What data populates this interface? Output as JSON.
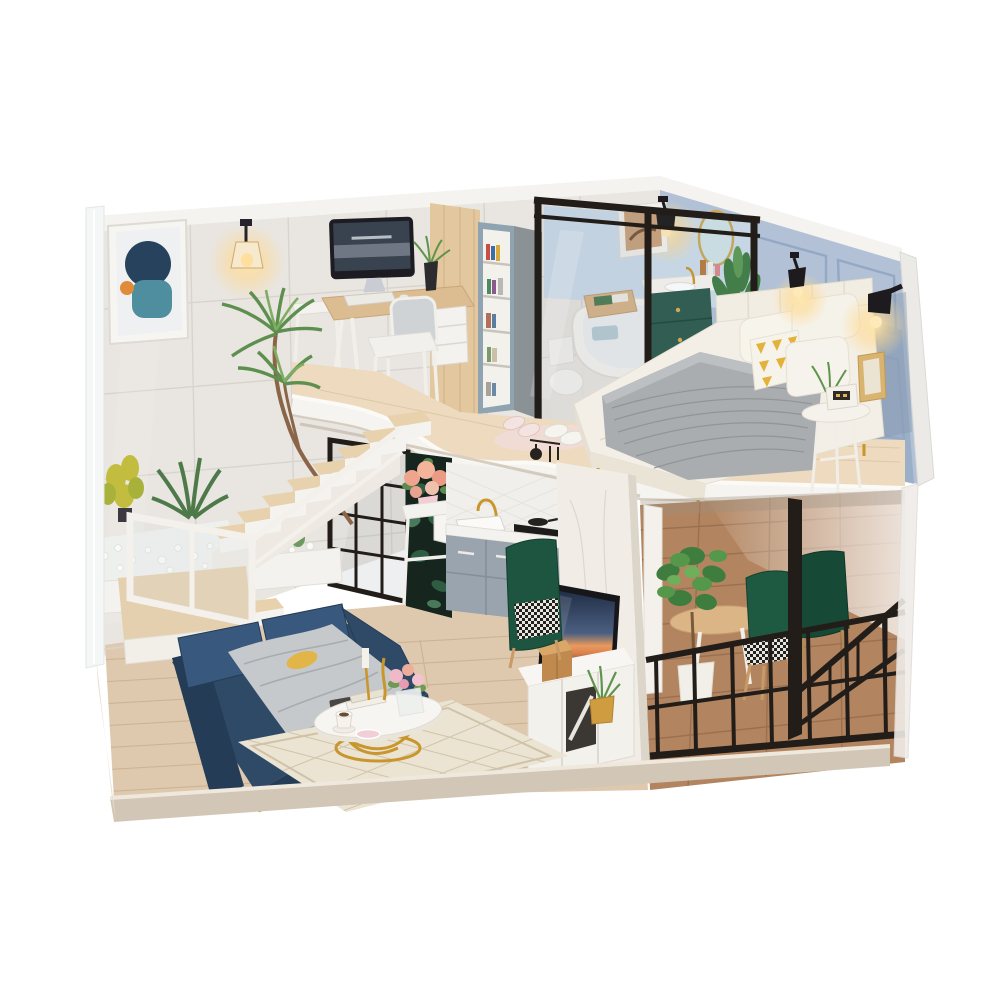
{
  "scene": {
    "type": "product-photo",
    "subject": "DIY miniature dollhouse kit — modern two-story loft apartment diorama with furniture, warm LED lights and acrylic dust cover, photographed on a plain white background",
    "view": "three-quarter view from front-right, roof open",
    "background": "#ffffff"
  },
  "colors": {
    "bg": "#ffffff",
    "wall_marble": "#e9e5e0",
    "wall_grout": "#d6d1ca",
    "wall_blue": "#b2c1d6",
    "wall_blue_dark": "#93a8c4",
    "wall_rim": "#f4f3f0",
    "wood_partition": "#e3c79f",
    "loft_fascia": "#f6f4f0",
    "loft_floor": "#eddabf",
    "floor_living": "#dfc9ae",
    "floor_plank": "#c3a988",
    "deck_wood": "#b28560",
    "deck_plank": "#936a4b",
    "base_fascia": "#d2c6b6",
    "stair_tread": "#e8d2ad",
    "stair_white": "#f3f0ea",
    "sofa_navy": "#2e4a66",
    "sofa_navy_dark": "#243c55",
    "sofa_cushion": "#38587d",
    "throw_gray": "#c6c9cb",
    "accent_yellow": "#e4b23a",
    "gold": "#c9962e",
    "black_metal": "#221d19",
    "vanity_green": "#2c5a4e",
    "chair_green": "#1e5a41",
    "plant_green": "#5f944d",
    "plant_green_light": "#84b06a",
    "plant_green_dark": "#3c6b3c",
    "tub_white": "#f7f5f2",
    "bed_white": "#f3efe7",
    "headboard": "#f2ede2",
    "knit_gray": "#a9adb0",
    "cabinet_gray": "#9aa4ae",
    "backsplash": "#f1efeb",
    "wallpaper_dark": "#16251d",
    "marble_column": "#f1ede6",
    "console_white": "#f3f1ec",
    "tv_bezel": "#17161a",
    "glow": "#ffd98f",
    "rug": "#ece4d3",
    "rug_line": "#cfc2a8",
    "slipper_pink": "#f0dcd8",
    "flower_peach": "#efa58d",
    "flower_pink": "#f0b9c8",
    "vacuum_white": "#eceae5",
    "pebble": "#fafaf8"
  },
  "inventory": {
    "structure": [
      {
        "name": "base-platform",
        "label": "wooden display base with beige edge"
      },
      {
        "name": "acrylic-cover",
        "label": "clear acrylic dust-cover edges"
      },
      {
        "name": "left-wall",
        "label": "white marble tiled wall"
      },
      {
        "name": "right-wall",
        "label": "light blue panelled wall"
      },
      {
        "name": "loft-slab",
        "label": "curved white-edged loft floor"
      },
      {
        "name": "staircase",
        "label": "white U-turn staircase with wood treads and landing"
      },
      {
        "name": "balcony-railing",
        "label": "black metal lattice railing"
      }
    ],
    "upper_floor": [
      {
        "name": "abstract-art",
        "label": "framed abstract poster"
      },
      {
        "name": "wall-lamp",
        "label": "glowing pendant wall lamp"
      },
      {
        "name": "desk",
        "label": "wood study desk with monitor, keyboard and drawer unit"
      },
      {
        "name": "desk-chair",
        "label": "white chair with gray cushion"
      },
      {
        "name": "bookshelf",
        "label": "blue-gray bookshelf with books"
      },
      {
        "name": "glass-partition",
        "label": "black framed glass bathroom partition"
      },
      {
        "name": "bathtub",
        "label": "white tub with wooden book tray"
      },
      {
        "name": "vanity",
        "label": "dark green floating vanity with gold knobs and mirror"
      },
      {
        "name": "bed",
        "label": "white bed with gray knit throw and yellow triangle pillow"
      },
      {
        "name": "bedside-table",
        "label": "round white table with clock and photo frame"
      },
      {
        "name": "sconces",
        "label": "three warm glowing black sconces"
      },
      {
        "name": "slippers",
        "label": "two pairs of slippers on pink mat"
      }
    ],
    "lower_floor": [
      {
        "name": "sofa",
        "label": "navy blue sofa with gray-yellow throw"
      },
      {
        "name": "coffee-table",
        "label": "round marble-top table with gold legs, flowers, cup, candle"
      },
      {
        "name": "rug",
        "label": "cream diamond-pattern rug"
      },
      {
        "name": "robot-vacuum",
        "label": "white robot vacuum"
      },
      {
        "name": "grid-screen",
        "label": "black metal grid partition"
      },
      {
        "name": "flower-stand",
        "label": "white stand with peach rose bouquet"
      },
      {
        "name": "kitchen",
        "label": "gray cabinets, sink, gold faucet, cooktop"
      },
      {
        "name": "tv-wall",
        "label": "white marble media column with sunset TV"
      },
      {
        "name": "tv-console",
        "label": "white console with gold storage box"
      },
      {
        "name": "dining-set",
        "label": "wood table with green velvet houndstooth chairs"
      },
      {
        "name": "plants",
        "label": "potted greenery throughout"
      }
    ]
  }
}
